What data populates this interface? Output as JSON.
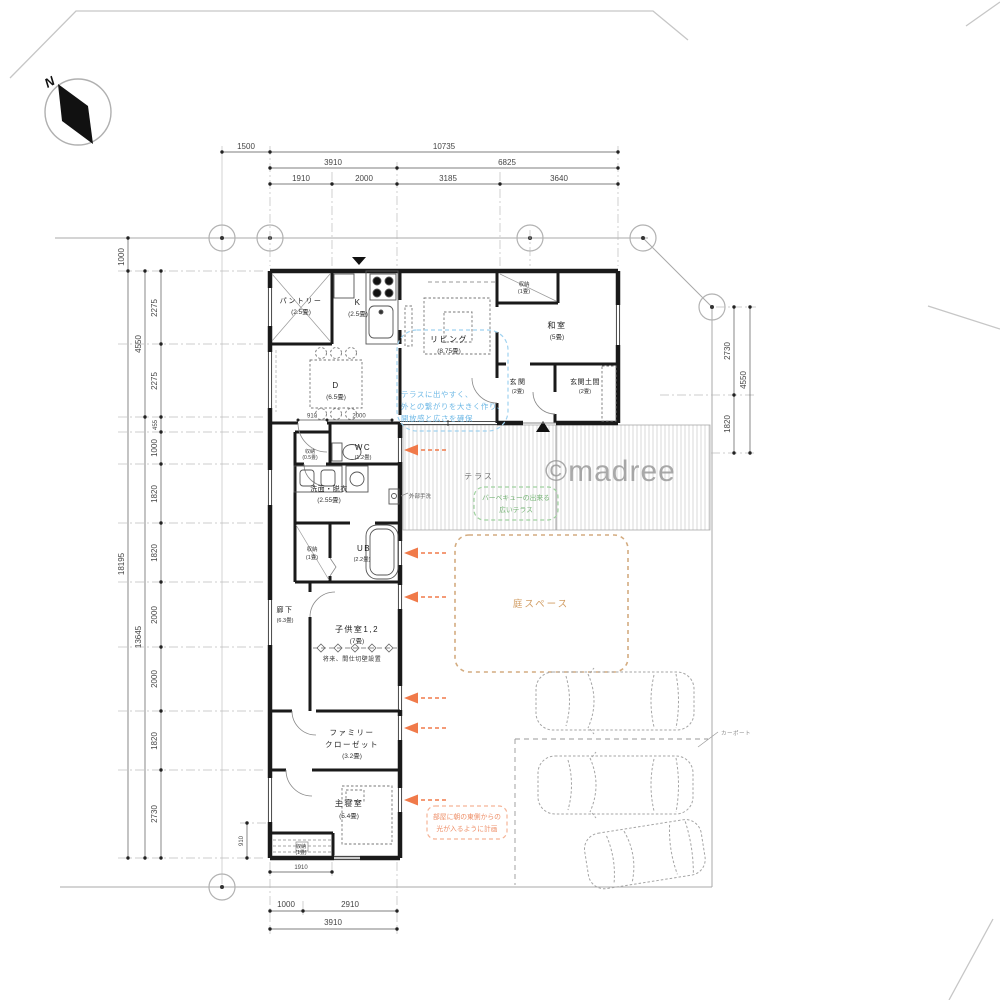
{
  "compass": {
    "label": "N"
  },
  "watermark": "©madree",
  "colors": {
    "wall": "#1a1a1a",
    "arrow_orange": "#f07a4a",
    "note_orange": "#ee8f68",
    "note_green": "#76b576",
    "note_blue": "#6fb9e6",
    "garden_tan": "#d19c62"
  },
  "dims": {
    "top_row1": [
      "1500",
      "10735"
    ],
    "top_row2": [
      "3910",
      "6825"
    ],
    "top_row3": [
      "1910",
      "2000",
      "3185",
      "3640"
    ],
    "left_outer": [
      "1000",
      "18195"
    ],
    "left_mid": [
      "4550",
      "13645"
    ],
    "left_inner": [
      "2275",
      "2275",
      "455",
      "1000",
      "1820",
      "1820",
      "2000",
      "2000",
      "1820",
      "2730"
    ],
    "right": [
      "2730",
      "1820",
      "4550"
    ],
    "interior": [
      "910",
      "2000"
    ],
    "bottom_910": "910",
    "bottom_row0": "1910",
    "bottom_row1": [
      "1000",
      "2910"
    ],
    "bottom_row2": "3910"
  },
  "rooms": {
    "pantry": {
      "name": "パントリー",
      "size": "(2.5畳)"
    },
    "kitchen": {
      "name": "K",
      "size": "(2.5畳)"
    },
    "living": {
      "name": "リビング",
      "size": "(8.75畳)"
    },
    "washitsu": {
      "name": "和室",
      "size": "(5畳)"
    },
    "storage_top": {
      "name": "収納",
      "size": "(1畳)"
    },
    "genkan": {
      "name": "玄関",
      "size": "(2畳)"
    },
    "genkan_doma": {
      "name": "玄関土間",
      "size": "(2畳)"
    },
    "dining": {
      "name": "D",
      "size": "(6.5畳)"
    },
    "wc": {
      "name": "WC",
      "size": "(1.2畳)"
    },
    "storage_wc": {
      "name": "収納",
      "size": "(0.5畳)"
    },
    "senmen": {
      "name": "洗面・脱衣",
      "size": "(2.55畳)"
    },
    "ub": {
      "name": "UB",
      "size": "(2.2畳)"
    },
    "storage_mid": {
      "name": "収納",
      "size": "(1畳)"
    },
    "rouka": {
      "name": "廊下",
      "size": "(6.3畳)"
    },
    "kids": {
      "name": "子供室1,2",
      "size": "(7畳)",
      "note": "将来、間仕切壁設置"
    },
    "fam_closet": {
      "line1": "ファミリー",
      "line2": "クローゼット",
      "size": "(3.2畳)"
    },
    "master": {
      "name": "主寝室",
      "size": "(5.4畳)"
    },
    "storage_bottom": {
      "name": "収納",
      "size": "(1畳)"
    }
  },
  "outdoor": {
    "terrace": "テラス",
    "garden": "庭スペース",
    "carport": "カーポート",
    "exterior_sink": "外部手洗"
  },
  "annotations": {
    "living_terrace": [
      "テラスに出やすく、",
      "外との繋がりを大きく作り、",
      "開放感と広さを確保"
    ],
    "terrace_bbq": [
      "バーベキューの出来る",
      "広いテラス"
    ],
    "morning_light": [
      "部屋に朝の東側からの",
      "光が入るように計画"
    ]
  }
}
